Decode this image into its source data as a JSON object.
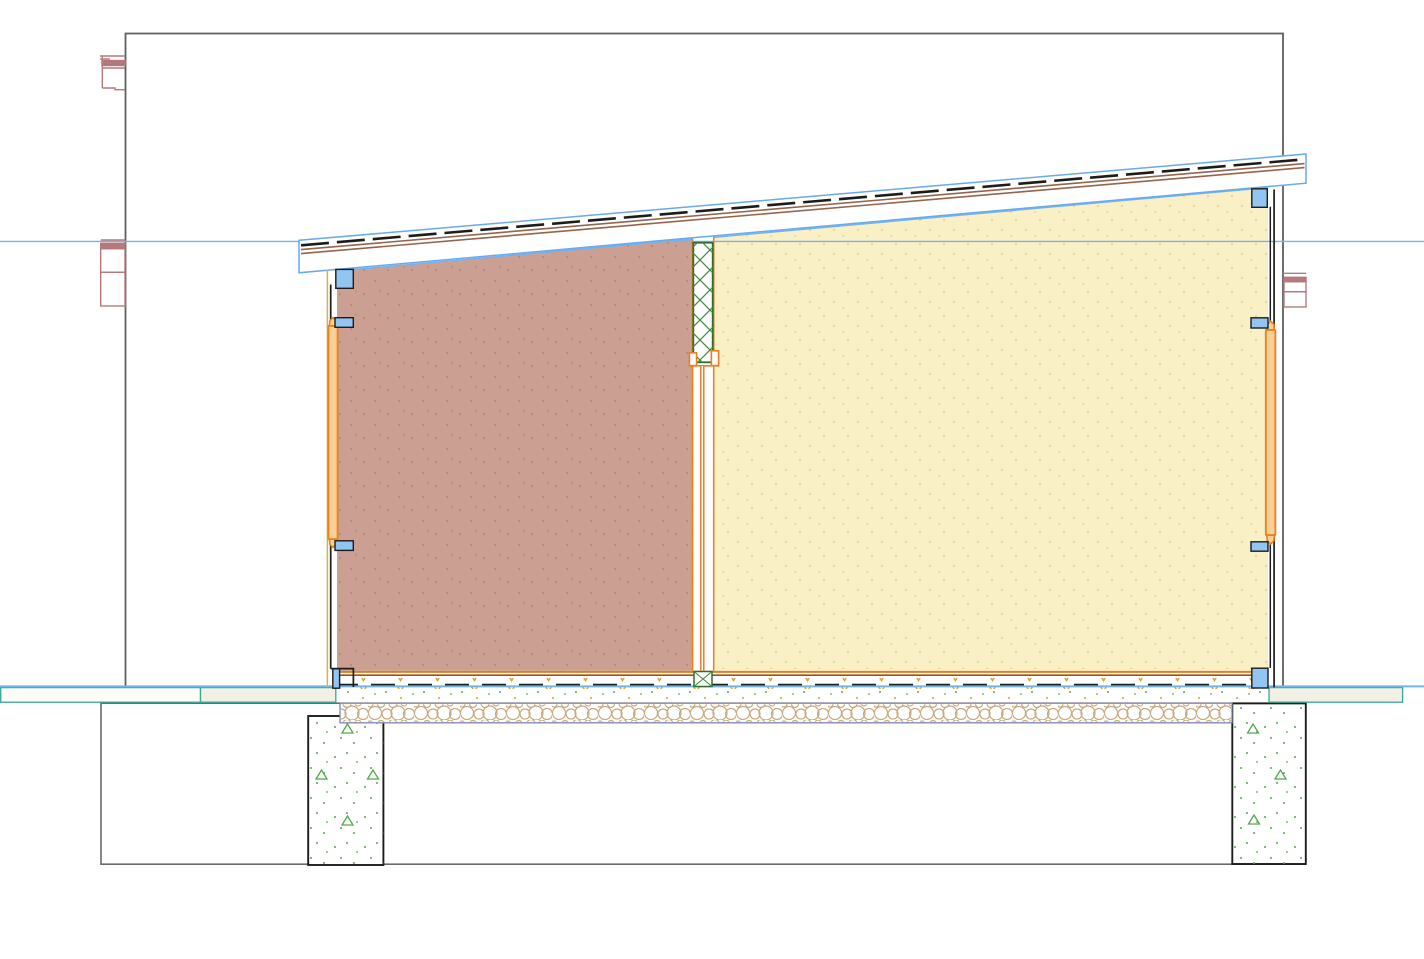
{
  "view": {
    "name": "building-section-drawing",
    "canvas_width": 1424,
    "canvas_height": 959,
    "background": "#ffffff"
  },
  "components": [
    "drawing-frame",
    "level-line",
    "ground-line",
    "roof-slab",
    "roof-membrane-line",
    "roof-batten-lines",
    "room-left",
    "room-right",
    "partition-column-hatch",
    "door-head-bracket",
    "door-leaf",
    "door-threshold",
    "wall-left",
    "wall-right",
    "window-frame-left",
    "window-frame-right",
    "anchor-marker",
    "floor-finish-line",
    "floor-sealing-line",
    "floor-insulation-dashes",
    "gravel-layer",
    "terrain-band-left",
    "terrain-band-right",
    "foundation-footer",
    "foundation-pier-left",
    "foundation-pier-right",
    "adjacent-structure-marks"
  ],
  "colors": {
    "ink": "#1c1c1c",
    "line-blue": "#74b2ee",
    "roof-outline": "#68aaec",
    "roof-brown": "#96644a",
    "room-left-fill": "#cba092",
    "room-right-fill": "#faf0c5",
    "frame-orange": "#ee7d1e",
    "frame-orange-fill": "#f9d096",
    "floor-orange": "#d9831d",
    "floor-red": "#a84a1c",
    "floor-gold": "#d7a93c",
    "marker-blue-fill": "#92c5f2",
    "hatch-green": "#3e8c3e",
    "hatch-border": "#2c6e2c",
    "terrain-teal": "#38a796",
    "terrain-beige": "#f2efe4",
    "gravel-border": "#7d85ab",
    "pebble-tan": "#c8a87e",
    "concrete-green": "#55a84f",
    "rose": "#b5797c",
    "frame-gray": "#5f5f5f",
    "footer-gray": "#6a6a6a",
    "wall-olive": "#d8b14a",
    "speckle-pink": "#7e564b",
    "speckle-yellow": "#b3943a",
    "ground-dot-green": "#76a23c",
    "ground-dot-gold": "#c8a43c"
  }
}
